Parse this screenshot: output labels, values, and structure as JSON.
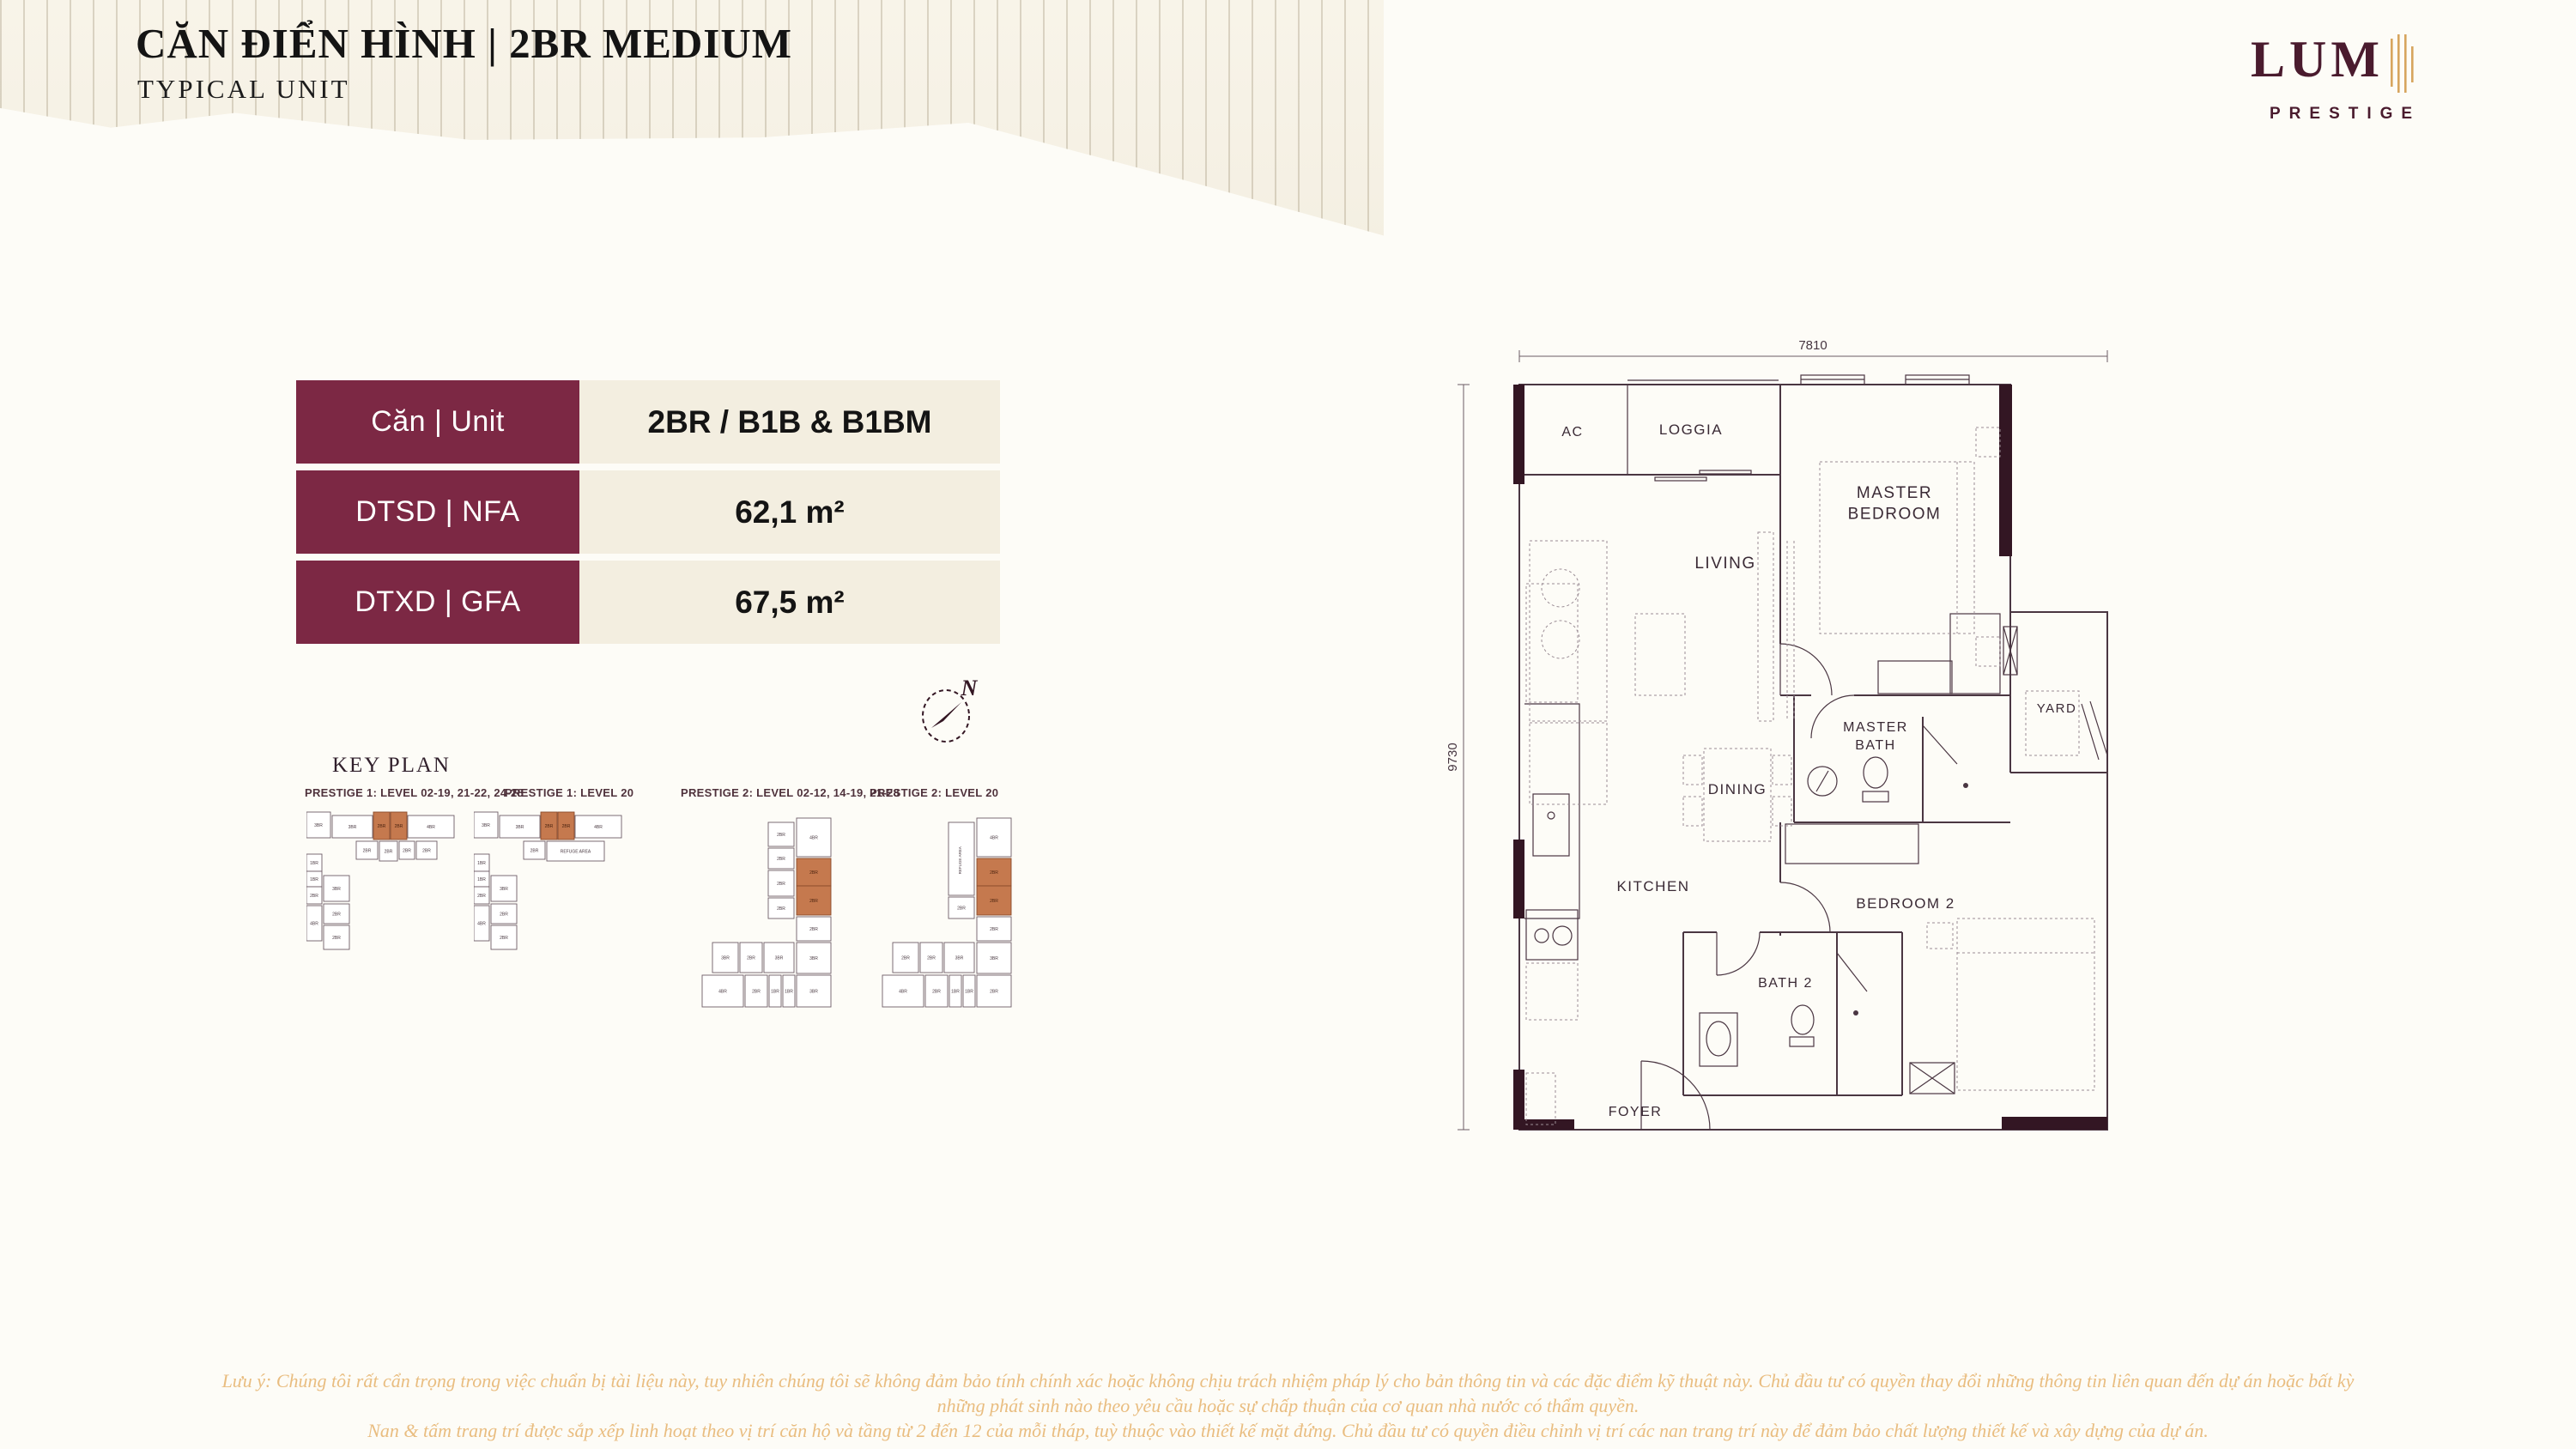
{
  "header": {
    "title": "CĂN ĐIỂN HÌNH | 2BR MEDIUM",
    "subtitle": "TYPICAL UNIT"
  },
  "logo": {
    "wordmark": "LUM",
    "tagline": "PRESTIGE",
    "maroon": "#4a1b2e",
    "gold": "#d7a55e"
  },
  "unit_table": {
    "rows": [
      {
        "label": "Căn | Unit",
        "value": "2BR / B1B & B1BM"
      },
      {
        "label": "DTSD  | NFA",
        "value": "62,1 m²"
      },
      {
        "label": "DTXD  | GFA",
        "value": "67,5 m²"
      }
    ]
  },
  "keyplan": {
    "heading": "KEY PLAN",
    "highlight_color": "#c5794e",
    "plans": [
      {
        "title": "PRESTIGE 1: LEVEL 02-19, 21-22, 24-28",
        "type": "A",
        "units": [
          {
            "label": "3BR"
          },
          {
            "label": "3BR"
          },
          {
            "label": "2BR",
            "hl": true
          },
          {
            "label": "2BR",
            "hl": true
          },
          {
            "label": "4BR"
          },
          {
            "label": "2BR"
          },
          {
            "label": "2BR"
          },
          {
            "label": "2BR"
          },
          {
            "label": "2BR"
          },
          {
            "label": "1BR"
          },
          {
            "label": "1BR"
          },
          {
            "label": "2BR"
          },
          {
            "label": "4BR"
          },
          {
            "label": "3BR"
          },
          {
            "label": "2BR"
          },
          {
            "label": "2BR"
          }
        ]
      },
      {
        "title": "PRESTIGE 1: LEVEL 20",
        "type": "A2",
        "units": [
          {
            "label": "3BR"
          },
          {
            "label": "3BR"
          },
          {
            "label": "2BR",
            "hl": true
          },
          {
            "label": "2BR",
            "hl": true
          },
          {
            "label": "4BR"
          },
          {
            "label": "2BR"
          },
          {
            "label": "REFUGE AREA"
          },
          {
            "label": "1BR"
          },
          {
            "label": "1BR"
          },
          {
            "label": "2BR"
          },
          {
            "label": "4BR"
          },
          {
            "label": "3BR"
          },
          {
            "label": "2BR"
          },
          {
            "label": "2BR"
          }
        ]
      },
      {
        "title": "PRESTIGE 2: LEVEL 02-12, 14-19, 21-28",
        "type": "B",
        "units": [
          {
            "label": "2BR"
          },
          {
            "label": "2BR"
          },
          {
            "label": "2BR"
          },
          {
            "label": "2BR"
          },
          {
            "label": "4BR"
          },
          {
            "label": "2BR",
            "hl": true
          },
          {
            "label": "2BR",
            "hl": true
          },
          {
            "label": "2BR"
          },
          {
            "label": "3BR"
          },
          {
            "label": "3BR"
          },
          {
            "label": "2BR"
          },
          {
            "label": "3BR"
          },
          {
            "label": "4BR"
          },
          {
            "label": "2BR"
          },
          {
            "label": "1BR"
          },
          {
            "label": "1BR"
          },
          {
            "label": "3BR"
          }
        ]
      },
      {
        "title": "PRESTIGE 2: LEVEL 20",
        "type": "B2",
        "units": [
          {
            "label": "REFUGE AREA"
          },
          {
            "label": "2BR"
          },
          {
            "label": "4BR"
          },
          {
            "label": "2BR",
            "hl": true
          },
          {
            "label": "2BR",
            "hl": true
          },
          {
            "label": "2BR"
          },
          {
            "label": "3BR"
          },
          {
            "label": "2BR"
          },
          {
            "label": "2BR"
          },
          {
            "label": "3BR"
          },
          {
            "label": "4BR"
          },
          {
            "label": "2BR"
          },
          {
            "label": "1BR"
          },
          {
            "label": "1BR"
          },
          {
            "label": "2BR"
          }
        ]
      }
    ]
  },
  "compass": {
    "label": "N"
  },
  "floorplan": {
    "dim_width": "7810",
    "dim_height": "9730",
    "labels": {
      "ac": "AC",
      "loggia": "LOGGIA",
      "master_bedroom": "MASTER\nBEDROOM",
      "living": "LIVING",
      "yard": "YARD",
      "master_bath": "MASTER\nBATH",
      "dining": "DINING",
      "kitchen": "KITCHEN",
      "bedroom2": "BEDROOM 2",
      "bath2": "BATH 2",
      "foyer": "FOYER"
    }
  },
  "disclaimer": {
    "lines": [
      "Lưu ý: Chúng tôi rất cẩn trọng trong việc chuẩn bị tài liệu này, tuy nhiên chúng tôi sẽ không đảm bảo tính chính xác hoặc không chịu trách nhiệm pháp lý cho bản thông tin và các đặc điểm kỹ thuật này. Chủ đầu tư có quyền thay đổi những thông tin liên quan đến dự án hoặc bất kỳ",
      "những phát sinh nào theo yêu cầu hoặc sự chấp thuận của cơ quan nhà nước có thẩm quyền.",
      "Nan & tấm trang trí được sắp xếp linh hoạt theo vị trí căn hộ và tầng từ 2 đến 12 của mỗi tháp, tuỳ thuộc vào thiết kế mặt đứng. Chủ đầu tư có quyền điều chỉnh vị trí các nan trang trí này để đảm bảo chất lượng thiết kế và xây dựng của dự án."
    ]
  }
}
